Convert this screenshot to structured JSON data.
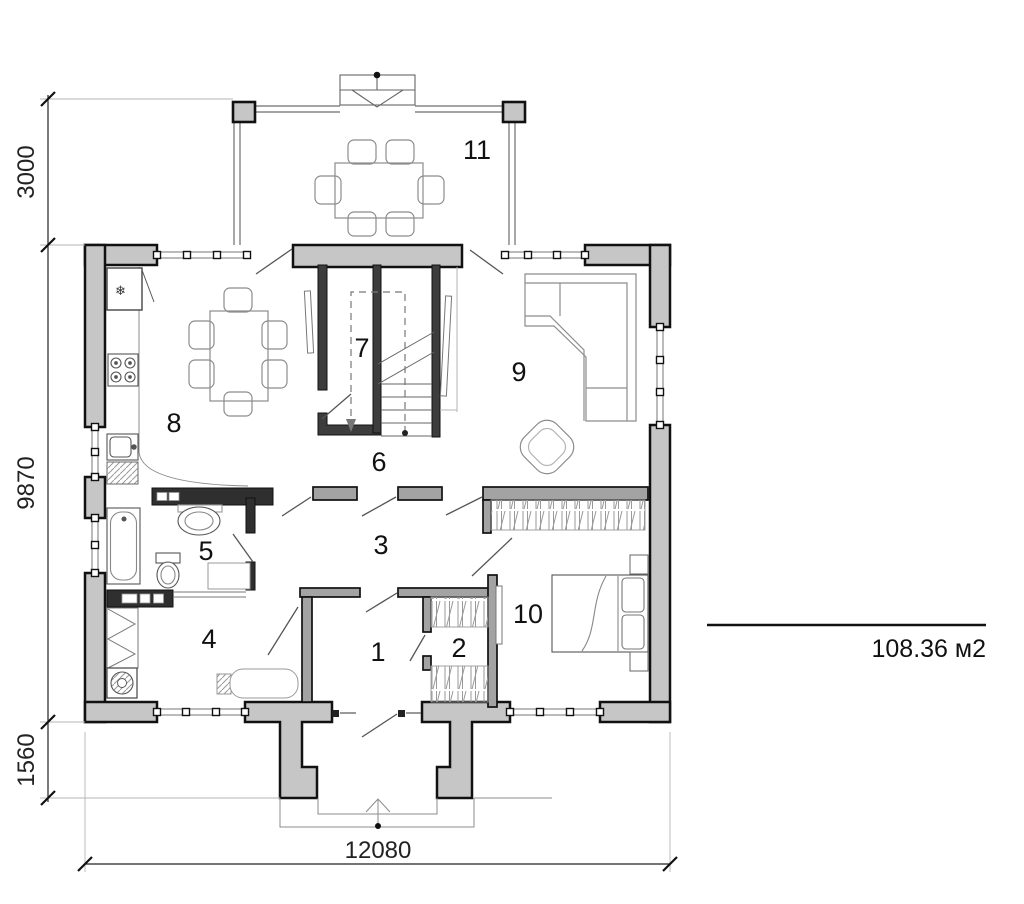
{
  "plan": {
    "rooms": {
      "r1": "1",
      "r2": "2",
      "r3": "3",
      "r4": "4",
      "r5": "5",
      "r6": "6",
      "r7": "7",
      "r8": "8",
      "r9": "9",
      "r10": "10",
      "r11": "11"
    },
    "dimensions": {
      "terrace_depth": "3000",
      "house_depth": "9870",
      "porch_depth": "1560",
      "house_width": "12080"
    },
    "area": {
      "label": "108.36 м2"
    },
    "icons": {
      "freezer": "❄"
    },
    "colors": {
      "exterior_wall_fill": "#c6c6c6",
      "partition_fill": "#a3a3a3",
      "dark_partition_fill": "#2f2f2f",
      "furniture_line": "#8c8c8c",
      "dimension_line": "#222222"
    }
  }
}
